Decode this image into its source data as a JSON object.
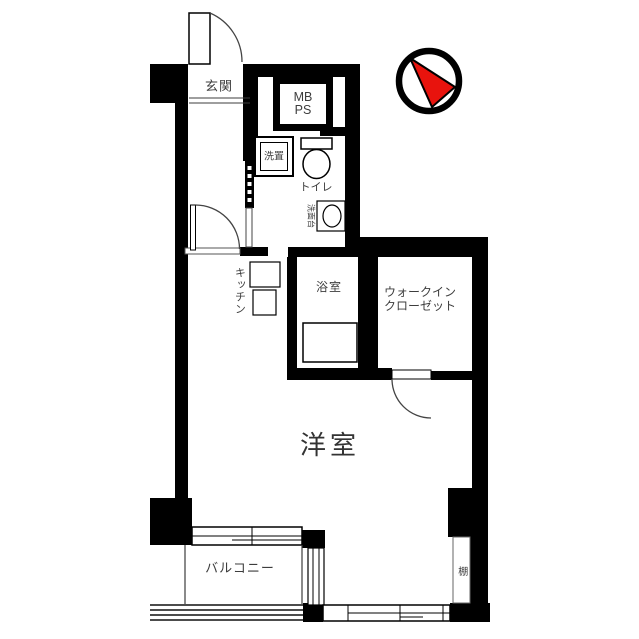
{
  "floorplan": {
    "labels": {
      "entrance": "玄関",
      "meter_box_line1": "MB",
      "meter_box_line2": "PS",
      "washer_space": "洗置",
      "toilet": "トイレ",
      "washbasin": "洗面台",
      "kitchen": "キッチン",
      "bathroom": "浴室",
      "walk_in_closet_line1": "ウォークイン",
      "walk_in_closet_line2": "クローゼット",
      "western_room": "洋室",
      "balcony": "バルコニー",
      "shelf": "棚"
    },
    "compass": {
      "needle_color": "#e8130d",
      "ring_color": "#000000"
    },
    "colors": {
      "wall": "#000000",
      "thin_line": "#3c3c3c",
      "text": "#3d3d3d",
      "background": "#ffffff"
    }
  }
}
